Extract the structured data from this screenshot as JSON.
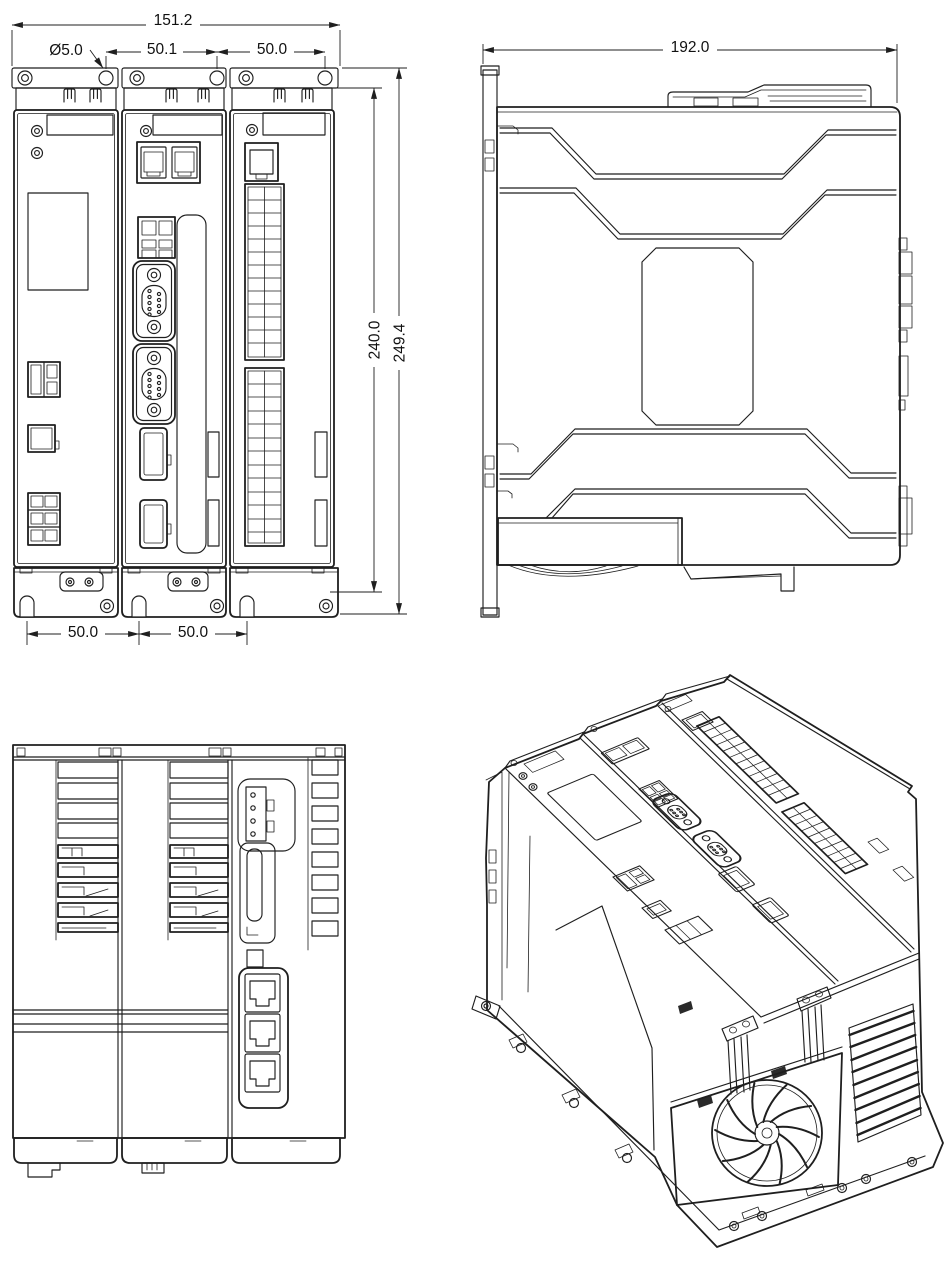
{
  "colors": {
    "line": "#1f1f1f",
    "background": "#ffffff"
  },
  "views": {
    "front": {
      "dims": {
        "overall_width": "151.2",
        "hole_dia": "Ø5.0",
        "top_pitch_a": "50.1",
        "top_pitch_b": "50.0",
        "body_height": "240.0",
        "total_height": "249.4",
        "bottom_pitch_a": "50.0",
        "bottom_pitch_b": "50.0"
      }
    },
    "side": {
      "dims": {
        "overall_depth": "192.0"
      }
    },
    "rear": {
      "dims": {}
    },
    "isometric": {
      "dims": {}
    }
  }
}
